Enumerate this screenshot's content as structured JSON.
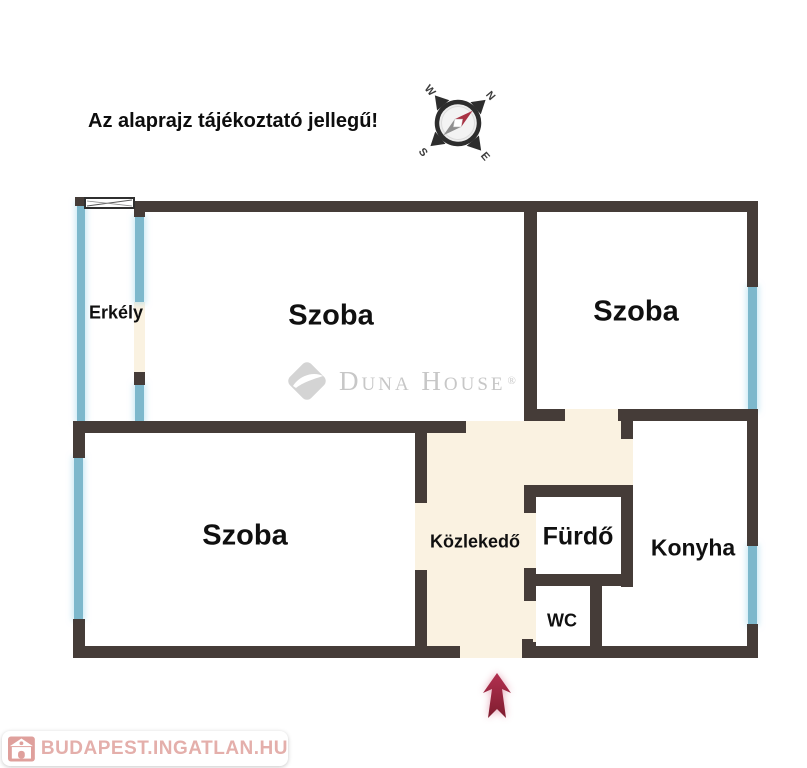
{
  "disclaimer": "Az alaprajz tájékoztató jellegű!",
  "compass": {
    "n": "N",
    "e": "E",
    "s": "S",
    "w": "W"
  },
  "rooms": {
    "erkely": "Erkély",
    "szoba_top_left": "Szoba",
    "szoba_right": "Szoba",
    "szoba_bottom_left": "Szoba",
    "kozlekedo": "Közlekedő",
    "furdo": "Fürdő",
    "wc": "WC",
    "konyha": "Konyha"
  },
  "watermarks": {
    "center_brand": "Duna House",
    "center_registered": "®",
    "corner_site": "BUDAPEST.INGATLAN.HU"
  },
  "colors": {
    "wall": "#453C38",
    "window_glass": "#7DB8CC",
    "door_floor": "#FAF2E1",
    "entrance_arrow": "#A02740",
    "corner_watermark_pink": "#E4AFAB",
    "center_watermark_gray": "#C7C7C7"
  }
}
